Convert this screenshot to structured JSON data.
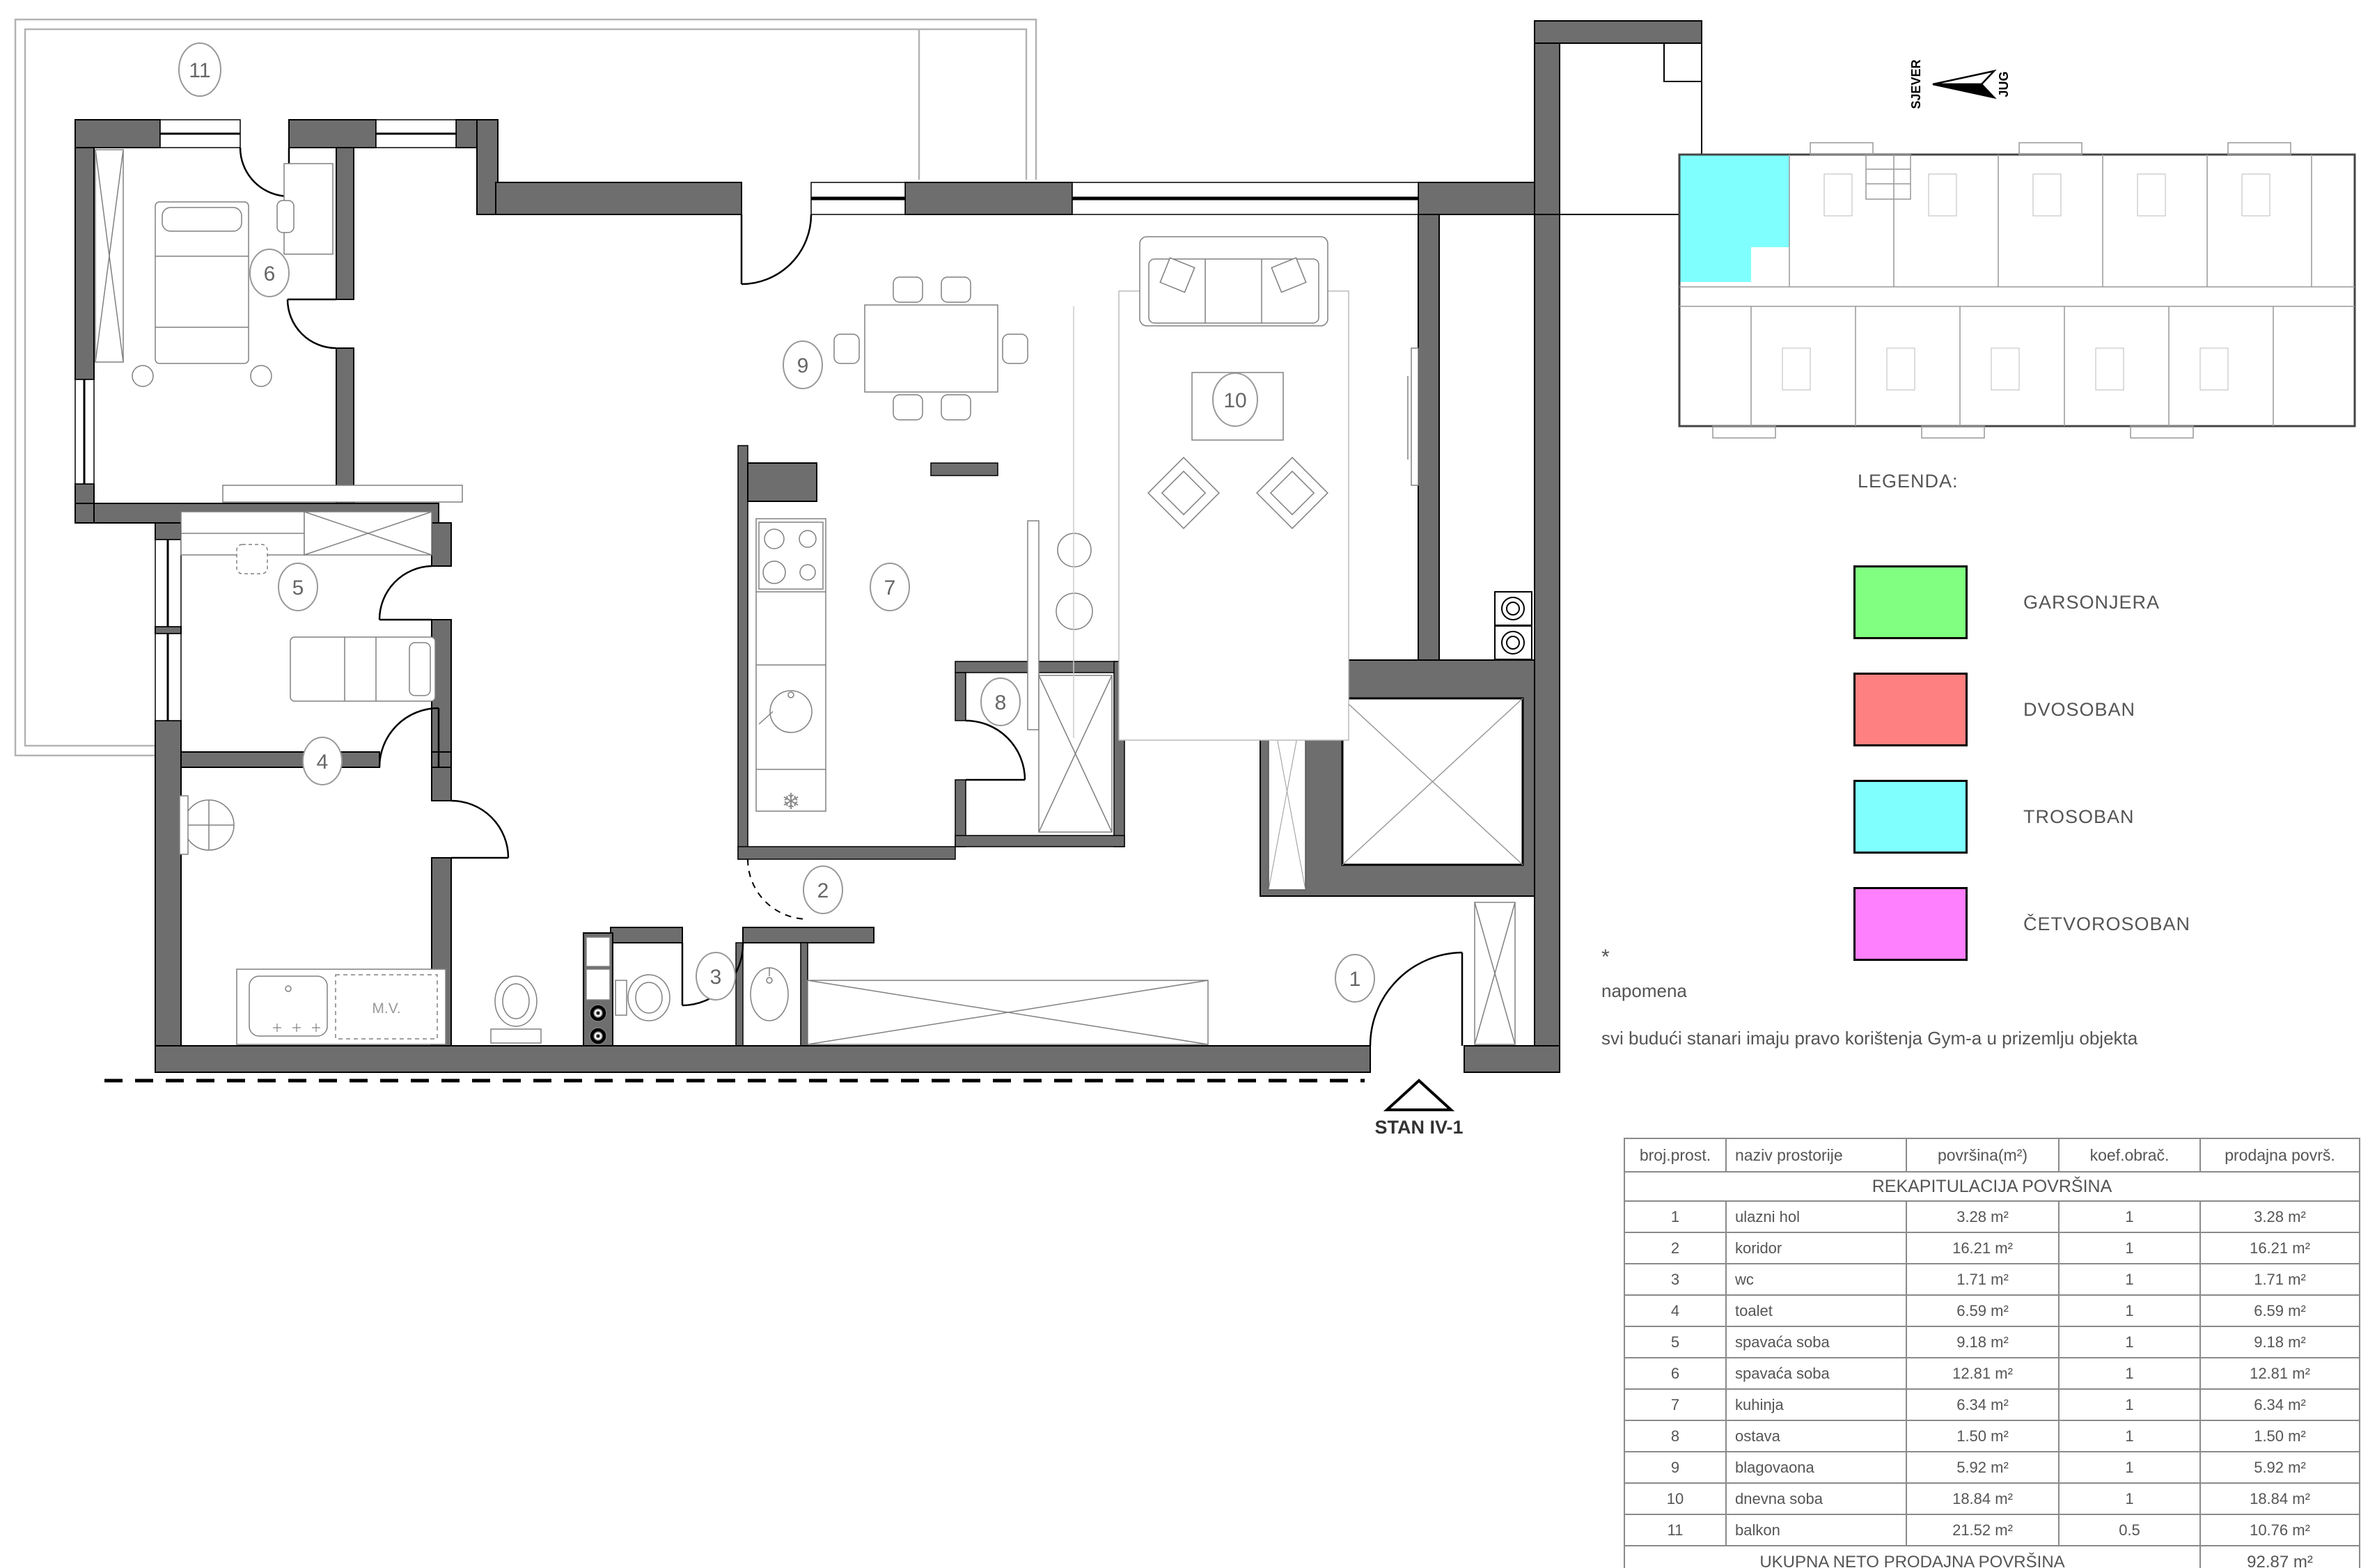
{
  "colors": {
    "garsonjera": "#80FF80",
    "dvosoban": "#FF8080",
    "trosoban": "#80FFFF",
    "cetvorosoban": "#FF80FF",
    "wall": "#6e6e6e"
  },
  "north": {
    "north_label": "SJEVER",
    "south_label": "JUG"
  },
  "plan": {
    "unit_label": "STAN IV-1",
    "mv_label": "M.V.",
    "freezer_icon": "❄",
    "room_numbers": [
      "1",
      "2",
      "3",
      "4",
      "5",
      "6",
      "7",
      "8",
      "9",
      "10",
      "11"
    ]
  },
  "legend": {
    "title": "LEGENDA:",
    "items": [
      {
        "label": "GARSONJERA",
        "color": "#80FF80"
      },
      {
        "label": "DVOSOBAN",
        "color": "#FF8080"
      },
      {
        "label": "TROSOBAN",
        "color": "#80FFFF"
      },
      {
        "label": "ČETVOROSOBAN",
        "color": "#FF80FF"
      }
    ]
  },
  "note": {
    "star": "*",
    "title": "napomena",
    "body": "svi budući stanari imaju pravo korištenja Gym-a u prizemlju objekta"
  },
  "table": {
    "title": "REKAPITULACIJA POVRŠINA",
    "headers": [
      "broj.prost.",
      "naziv prostorije",
      "površina(m²)",
      "koef.obrač.",
      "prodajna površ."
    ],
    "rows": [
      [
        "1",
        "ulazni hol",
        "3.28 m²",
        "1",
        "3.28 m²"
      ],
      [
        "2",
        "koridor",
        "16.21 m²",
        "1",
        "16.21 m²"
      ],
      [
        "3",
        "wc",
        "1.71 m²",
        "1",
        "1.71 m²"
      ],
      [
        "4",
        "toalet",
        "6.59 m²",
        "1",
        "6.59 m²"
      ],
      [
        "5",
        "spavaća soba",
        "9.18 m²",
        "1",
        "9.18 m²"
      ],
      [
        "6",
        "spavaća soba",
        "12.81 m²",
        "1",
        "12.81 m²"
      ],
      [
        "7",
        "kuhinja",
        "6.34 m²",
        "1",
        "6.34 m²"
      ],
      [
        "8",
        "ostava",
        "1.50 m²",
        "1",
        "1.50 m²"
      ],
      [
        "9",
        "blagovaona",
        "5.92 m²",
        "1",
        "5.92 m²"
      ],
      [
        "10",
        "dnevna soba",
        "18.84 m²",
        "1",
        "18.84 m²"
      ],
      [
        "11",
        "balkon",
        "21.52 m²",
        "0.5",
        "10.76 m²"
      ]
    ],
    "footer": {
      "label": "UKUPNA NETO PRODAJNA POVRŠINA",
      "value": "92.87 m²"
    }
  }
}
